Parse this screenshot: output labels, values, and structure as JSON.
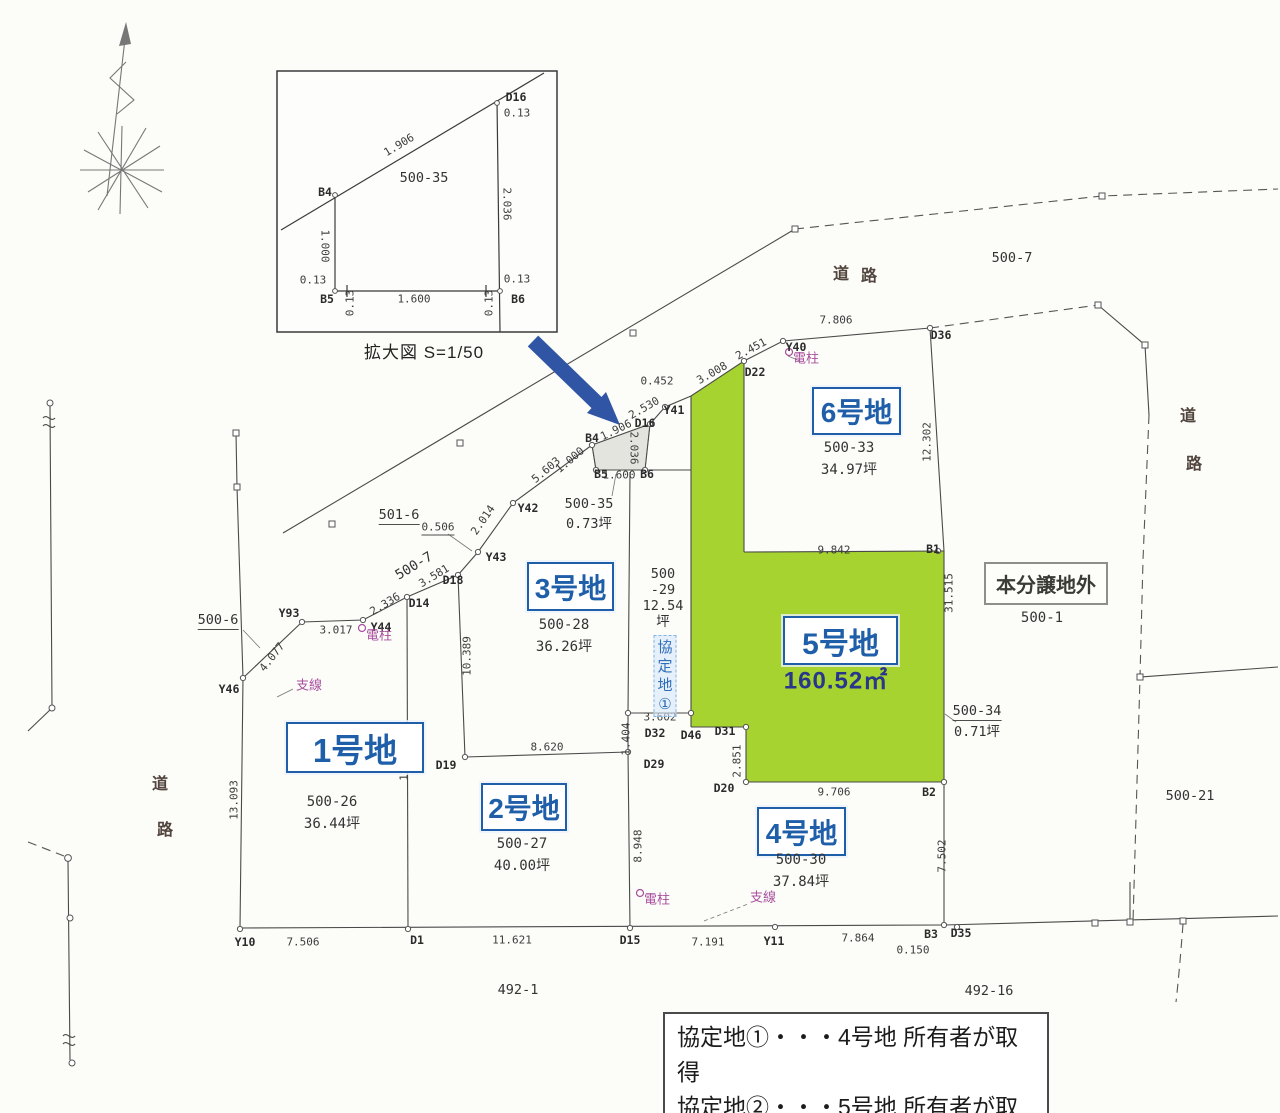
{
  "colors": {
    "highlight_green": "#a6d32f",
    "plot_label_blue": "#1f5fa9",
    "area_navy": "#28368c",
    "utility_purple": "#a84f9e",
    "arrow_blue": "#2f55a4",
    "line_gray": "#4a4a4a"
  },
  "inset": {
    "caption": "拡大図 S=1/50",
    "lot": "500-35"
  },
  "note": {
    "line1": "協定地①・・・4号地 所有者が取得",
    "line2": "協定地②・・・5号地 所有者が取得"
  },
  "plots": [
    {
      "id": "1-gouchi",
      "label": "1号地",
      "box": {
        "x": 286,
        "y": 722,
        "w": 134,
        "h": 47
      },
      "font": 33,
      "sub": {
        "x": 332,
        "y": 791,
        "lines": [
          "500-26",
          "36.44坪"
        ]
      }
    },
    {
      "id": "2-gouchi",
      "label": "2号地",
      "box": {
        "x": 481,
        "y": 783,
        "w": 82,
        "h": 44
      },
      "font": 28,
      "sub": {
        "x": 522,
        "y": 833,
        "lines": [
          "500-27",
          "40.00坪"
        ]
      }
    },
    {
      "id": "3-gouchi",
      "label": "3号地",
      "box": {
        "x": 527,
        "y": 562,
        "w": 83,
        "h": 45
      },
      "font": 28,
      "sub": {
        "x": 564,
        "y": 614,
        "lines": [
          "500-28",
          "36.26坪"
        ]
      }
    },
    {
      "id": "4-gouchi",
      "label": "4号地",
      "box": {
        "x": 757,
        "y": 807,
        "w": 85,
        "h": 45
      },
      "font": 28,
      "sub": {
        "x": 801,
        "y": 849,
        "lines": [
          "500-30",
          "37.84坪"
        ]
      }
    },
    {
      "id": "5-gouchi",
      "label": "5号地",
      "box": {
        "x": 783,
        "y": 616,
        "w": 111,
        "h": 45
      },
      "font": 30,
      "area_label": {
        "t": "160.52㎡",
        "x": 836,
        "y": 678
      }
    },
    {
      "id": "6-gouchi",
      "label": "6号地",
      "box": {
        "x": 812,
        "y": 387,
        "w": 85,
        "h": 44
      },
      "font": 28,
      "sub": {
        "x": 849,
        "y": 437,
        "lines": [
          "500-33",
          "34.97坪"
        ]
      }
    },
    {
      "id": "outside",
      "label": "本分譲地外",
      "style": "outside",
      "box": {
        "x": 984,
        "y": 562,
        "w": 120,
        "h": 39
      },
      "font": 20,
      "sub": {
        "x": 1042,
        "y": 607,
        "lines": [
          "500-1"
        ]
      }
    }
  ],
  "labels": {
    "measurements": [
      {
        "t": "1.906",
        "x": 399,
        "y": 145,
        "r": -31
      },
      {
        "t": "0.13",
        "x": 517,
        "y": 113
      },
      {
        "t": "2.036",
        "x": 507,
        "y": 204,
        "r": 90
      },
      {
        "t": "0.13",
        "x": 517,
        "y": 279
      },
      {
        "t": "0.13",
        "x": 489,
        "y": 303,
        "r": -90
      },
      {
        "t": "1.600",
        "x": 414,
        "y": 299
      },
      {
        "t": "0.13",
        "x": 350,
        "y": 303,
        "r": -90
      },
      {
        "t": "0.13",
        "x": 313,
        "y": 280
      },
      {
        "t": "1.000",
        "x": 325,
        "y": 246,
        "r": 90
      },
      {
        "t": "7.506",
        "x": 303,
        "y": 942
      },
      {
        "t": "11.621",
        "x": 512,
        "y": 940
      },
      {
        "t": "7.191",
        "x": 708,
        "y": 942
      },
      {
        "t": "7.864",
        "x": 858,
        "y": 938
      },
      {
        "t": "0.150",
        "x": 913,
        "y": 950
      },
      {
        "t": "13.093",
        "x": 234,
        "y": 800,
        "r": -90
      },
      {
        "t": "17.385",
        "x": 404,
        "y": 761,
        "r": -90
      },
      {
        "t": "10.389",
        "x": 467,
        "y": 656,
        "r": -90
      },
      {
        "t": "8.620",
        "x": 547,
        "y": 747
      },
      {
        "t": "8.948",
        "x": 638,
        "y": 846,
        "r": -90
      },
      {
        "t": "1.404",
        "x": 626,
        "y": 739,
        "r": -90
      },
      {
        "t": "3.602",
        "x": 660,
        "y": 717
      },
      {
        "t": "2.851",
        "x": 737,
        "y": 761,
        "r": -90
      },
      {
        "t": "9.706",
        "x": 834,
        "y": 792
      },
      {
        "t": "7.502",
        "x": 942,
        "y": 856,
        "r": -90
      },
      {
        "t": "9.842",
        "x": 834,
        "y": 550
      },
      {
        "t": "31.515",
        "x": 949,
        "y": 593,
        "r": -90
      },
      {
        "t": "12.302",
        "x": 927,
        "y": 442,
        "r": -90
      },
      {
        "t": "7.806",
        "x": 836,
        "y": 320
      },
      {
        "t": "2.451",
        "x": 751,
        "y": 349,
        "r": -28
      },
      {
        "t": "3.008",
        "x": 712,
        "y": 373,
        "r": -30
      },
      {
        "t": "0.452",
        "x": 657,
        "y": 381
      },
      {
        "t": "2.530",
        "x": 644,
        "y": 408,
        "r": -30
      },
      {
        "t": "1.906",
        "x": 616,
        "y": 430,
        "r": -26
      },
      {
        "t": "2.036",
        "x": 634,
        "y": 448,
        "r": 90
      },
      {
        "t": "1.000",
        "x": 570,
        "y": 460,
        "r": -40
      },
      {
        "t": "1.600",
        "x": 619,
        "y": 475
      },
      {
        "t": "5.603",
        "x": 546,
        "y": 470,
        "r": -40
      },
      {
        "t": "2.014",
        "x": 483,
        "y": 520,
        "r": -55
      },
      {
        "t": "0.506",
        "x": 438,
        "y": 528,
        "u": 1
      },
      {
        "t": "3.581",
        "x": 434,
        "y": 576,
        "r": -31
      },
      {
        "t": "2.336",
        "x": 385,
        "y": 604,
        "r": -31
      },
      {
        "t": "3.017",
        "x": 336,
        "y": 630
      },
      {
        "t": "4.077",
        "x": 272,
        "y": 657,
        "r": -52
      }
    ],
    "points": [
      {
        "t": "D16",
        "x": 516,
        "y": 97
      },
      {
        "t": "B4",
        "x": 325,
        "y": 192
      },
      {
        "t": "B5",
        "x": 327,
        "y": 299
      },
      {
        "t": "B6",
        "x": 518,
        "y": 299
      },
      {
        "t": "Y10",
        "x": 245,
        "y": 942
      },
      {
        "t": "D1",
        "x": 417,
        "y": 940
      },
      {
        "t": "D15",
        "x": 630,
        "y": 940
      },
      {
        "t": "Y11",
        "x": 774,
        "y": 941
      },
      {
        "t": "B3",
        "x": 931,
        "y": 934
      },
      {
        "t": "D35",
        "x": 961,
        "y": 933
      },
      {
        "t": "Y46",
        "x": 229,
        "y": 689
      },
      {
        "t": "Y93",
        "x": 289,
        "y": 613
      },
      {
        "t": "Y44",
        "x": 381,
        "y": 627
      },
      {
        "t": "D14",
        "x": 419,
        "y": 603
      },
      {
        "t": "D18",
        "x": 453,
        "y": 580
      },
      {
        "t": "Y43",
        "x": 496,
        "y": 557
      },
      {
        "t": "Y42",
        "x": 528,
        "y": 508
      },
      {
        "t": "B4",
        "x": 592,
        "y": 438
      },
      {
        "t": "B5",
        "x": 601,
        "y": 474
      },
      {
        "t": "B6",
        "x": 647,
        "y": 474
      },
      {
        "t": "D16",
        "x": 645,
        "y": 423
      },
      {
        "t": "Y41",
        "x": 674,
        "y": 410
      },
      {
        "t": "D22",
        "x": 755,
        "y": 372
      },
      {
        "t": "Y40",
        "x": 796,
        "y": 347
      },
      {
        "t": "D36",
        "x": 941,
        "y": 335
      },
      {
        "t": "B1",
        "x": 933,
        "y": 549
      },
      {
        "t": "B2",
        "x": 929,
        "y": 792
      },
      {
        "t": "D19",
        "x": 446,
        "y": 765
      },
      {
        "t": "D32",
        "x": 655,
        "y": 733
      },
      {
        "t": "D46",
        "x": 691,
        "y": 735
      },
      {
        "t": "D31",
        "x": 725,
        "y": 731
      },
      {
        "t": "D29",
        "x": 654,
        "y": 764
      },
      {
        "t": "D20",
        "x": 724,
        "y": 788
      }
    ],
    "lots": [
      {
        "t": "500-7",
        "x": 1012,
        "y": 258
      },
      {
        "t": "500-6",
        "x": 218,
        "y": 621,
        "u": 1
      },
      {
        "t": "501-6",
        "x": 399,
        "y": 516,
        "u": 1
      },
      {
        "t": "500-7",
        "x": 414,
        "y": 566,
        "r": -31
      },
      {
        "t": "500-35",
        "x": 589,
        "y": 504
      },
      {
        "t": "0.73坪",
        "x": 589,
        "y": 524
      },
      {
        "t": "500-34",
        "x": 977,
        "y": 712,
        "u": 1
      },
      {
        "t": "0.71坪",
        "x": 977,
        "y": 732
      },
      {
        "t": "500-21",
        "x": 1190,
        "y": 796
      },
      {
        "t": "492-1",
        "x": 518,
        "y": 990
      },
      {
        "t": "492-16",
        "x": 989,
        "y": 991
      },
      {
        "t": "500-35",
        "x": 424,
        "y": 178
      },
      {
        "lines": [
          "500",
          "-29",
          "12.54",
          "坪"
        ],
        "x": 663,
        "y": 598
      }
    ],
    "roads": [
      {
        "t": "道",
        "x": 841,
        "y": 272
      },
      {
        "t": "路",
        "x": 869,
        "y": 274
      },
      {
        "t": "道",
        "x": 1188,
        "y": 414
      },
      {
        "t": "路",
        "x": 1194,
        "y": 462
      },
      {
        "t": "道",
        "x": 160,
        "y": 782
      },
      {
        "t": "路",
        "x": 165,
        "y": 828
      }
    ],
    "utilities": [
      {
        "t": "電柱",
        "x": 806,
        "y": 357
      },
      {
        "t": "電柱",
        "x": 379,
        "y": 634
      },
      {
        "t": "支線",
        "x": 309,
        "y": 684
      },
      {
        "t": "電柱",
        "x": 657,
        "y": 898
      },
      {
        "t": "支線",
        "x": 763,
        "y": 896
      }
    ],
    "agreements": [
      {
        "lines": [
          "協",
          "定",
          "地",
          "①"
        ],
        "x": 665,
        "y": 676
      }
    ]
  }
}
